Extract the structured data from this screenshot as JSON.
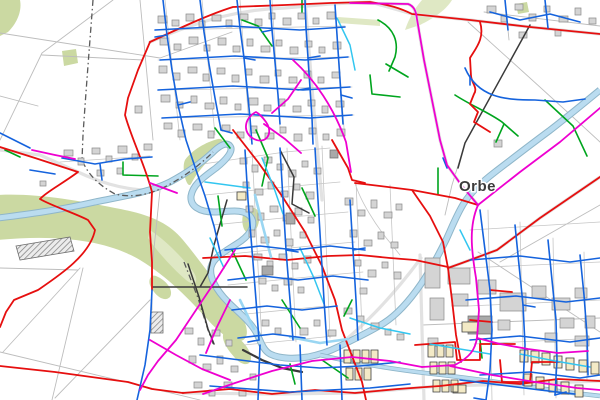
{
  "map": {
    "place_label": "Orbe",
    "palette": {
      "background": "#ffffff",
      "field_line": "#bdbdbd",
      "street_line": "#c6c6c6",
      "road_casing": "#e2e2e2",
      "boundary": "#5a5a5a",
      "green_area": "#cbd9a2",
      "green_area_light": "#dfe8c4",
      "river_fill": "#badcf0",
      "river_edge": "#8fb6c9",
      "building_fill": "#d4d4d4",
      "building_stroke": "#8c8c8c",
      "building_dark": "#a9a9a9",
      "building_beige": "#f3eac6",
      "building_beige_stroke": "#3f3f3f",
      "network_red": "#e60f0f",
      "network_blue": "#1563dd",
      "network_green": "#00a51e",
      "network_magenta": "#ee00d0",
      "network_cyan": "#33c6f0",
      "network_cyan_pale": "#9ad6f2",
      "network_black": "#3a3a3a",
      "label_color": "#3b3b3b"
    }
  }
}
